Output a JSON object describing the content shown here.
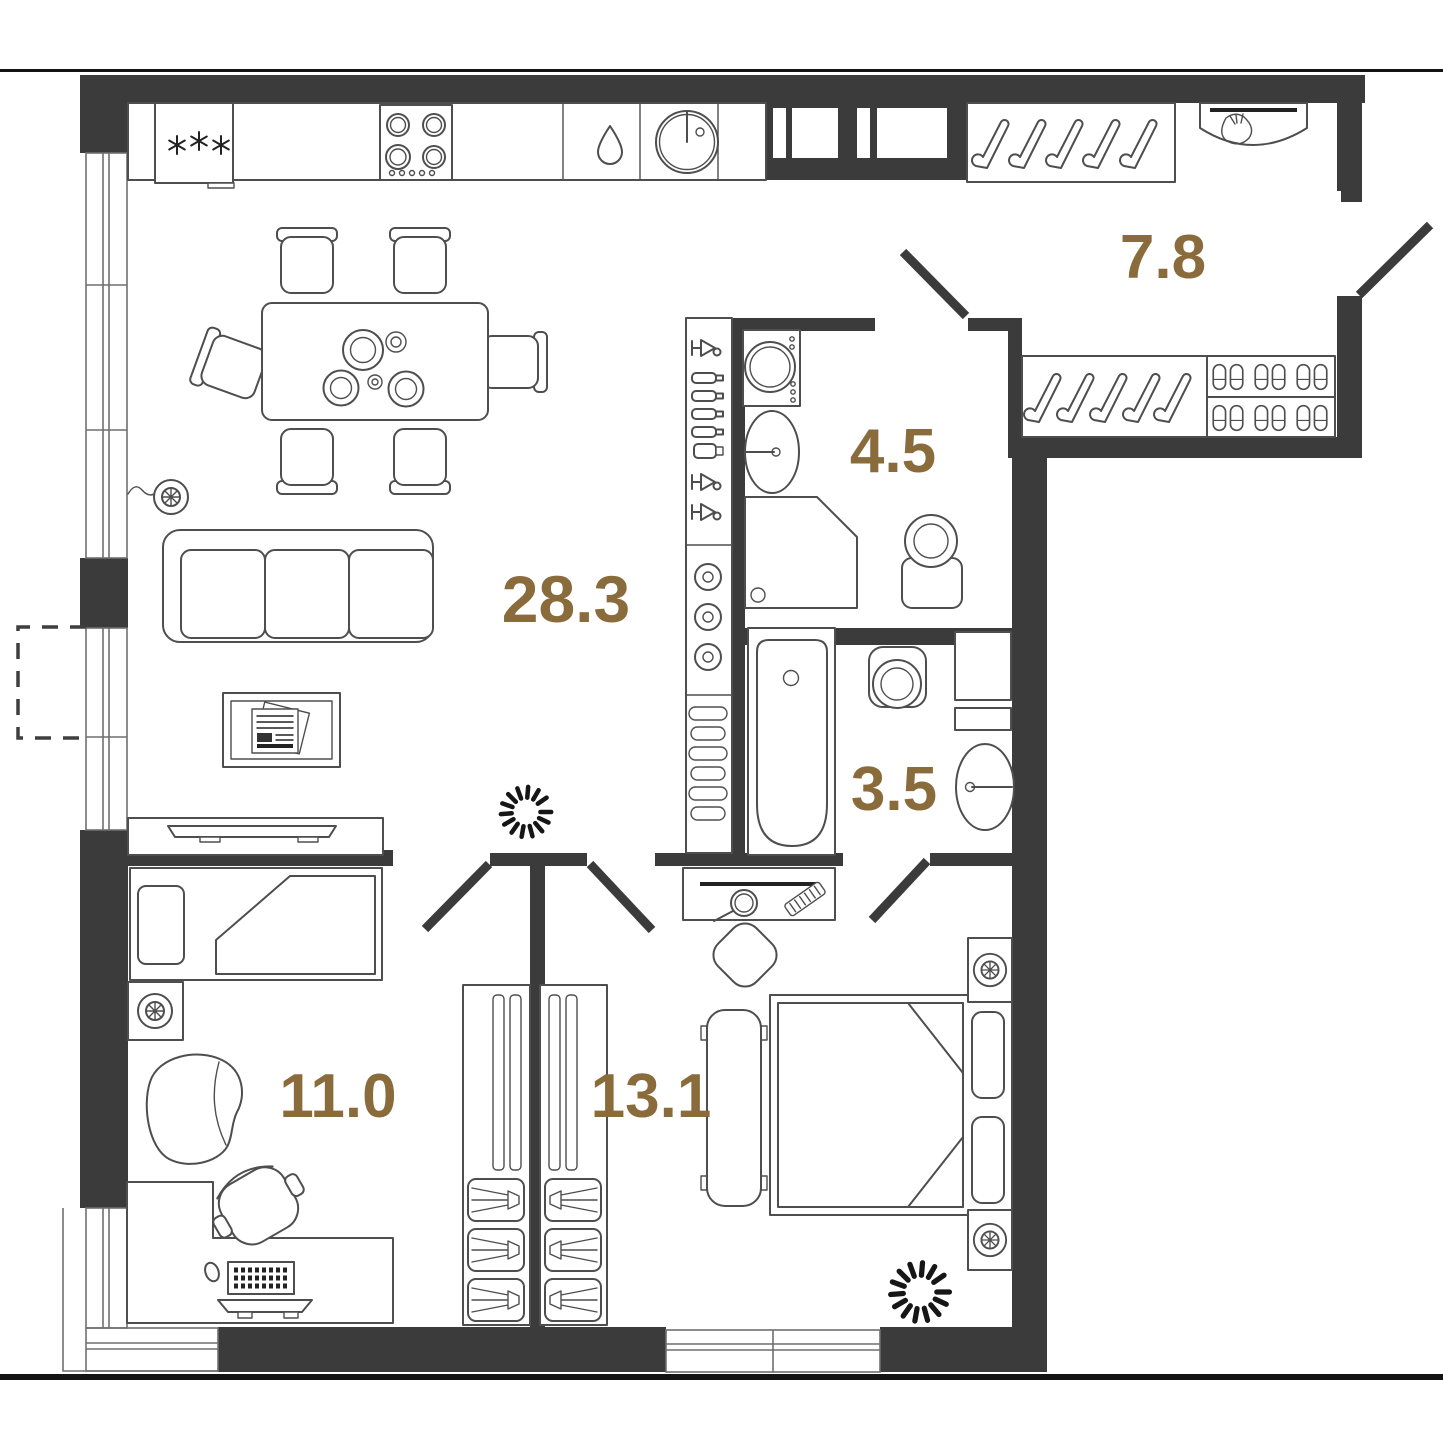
{
  "colors": {
    "wall": "#3b3b3b",
    "line": "#4e4e4e",
    "label": "#8a6c3c",
    "rule": "#141414",
    "bg": "#ffffff"
  },
  "rooms": {
    "living_kitchen": {
      "area": "28.3"
    },
    "hall": {
      "area": "7.8"
    },
    "shower_room": {
      "area": "4.5"
    },
    "bathroom": {
      "area": "3.5"
    },
    "bedroom_small": {
      "area": "11.0"
    },
    "bedroom_master": {
      "area": "13.1"
    }
  }
}
